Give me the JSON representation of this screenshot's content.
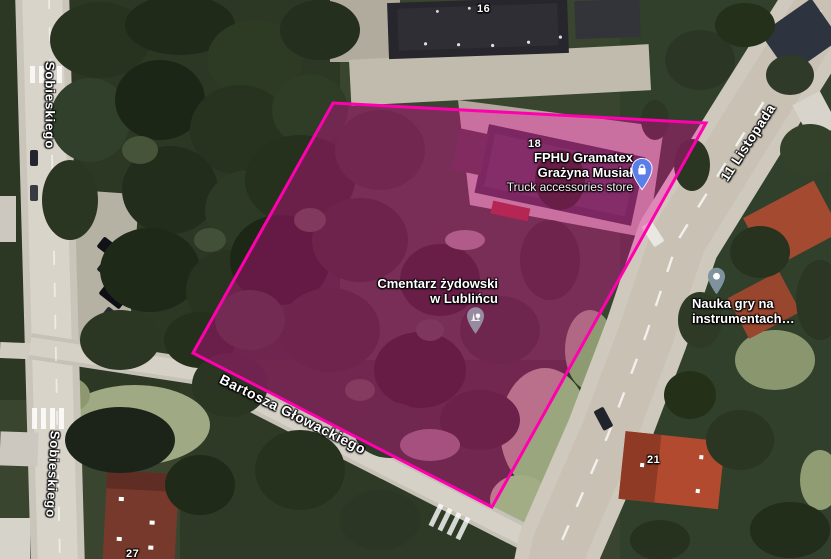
{
  "map": {
    "streets": {
      "sobieskiego_top": {
        "label": "Sobieskiego"
      },
      "sobieskiego_bottom": {
        "label": "Sobieskiego"
      },
      "listopada": {
        "label": "11 Listopada"
      },
      "glowackiego": {
        "label": "Bartosza Głowackiego"
      }
    },
    "house_numbers": {
      "n16": "16",
      "n18": "18",
      "n21": "21",
      "n27": "27"
    },
    "pois": {
      "gramatex": {
        "name_line1": "FPHU Gramatex",
        "name_line2": "Grażyna Musiał",
        "category": "Truck accessories store",
        "icon": "shopping-bag-pin-icon",
        "pin_color": "#5b7ee9"
      },
      "cemetery": {
        "name_line1": "Cmentarz żydowski",
        "name_line2": "w Lublińcu",
        "icon": "cemetery-trees-pin-icon",
        "pin_color": "#968ba0"
      },
      "music_school": {
        "name_line1": "Nauka gry na",
        "name_line2": "instrumentach…",
        "icon": "generic-poi-pin-icon",
        "pin_color": "#7f939e"
      }
    },
    "highlight": {
      "stroke": "#ff00ae",
      "fill": "rgba(255,0,170,0.32)",
      "points": "333,103 706,123 492,507 193,353"
    }
  }
}
